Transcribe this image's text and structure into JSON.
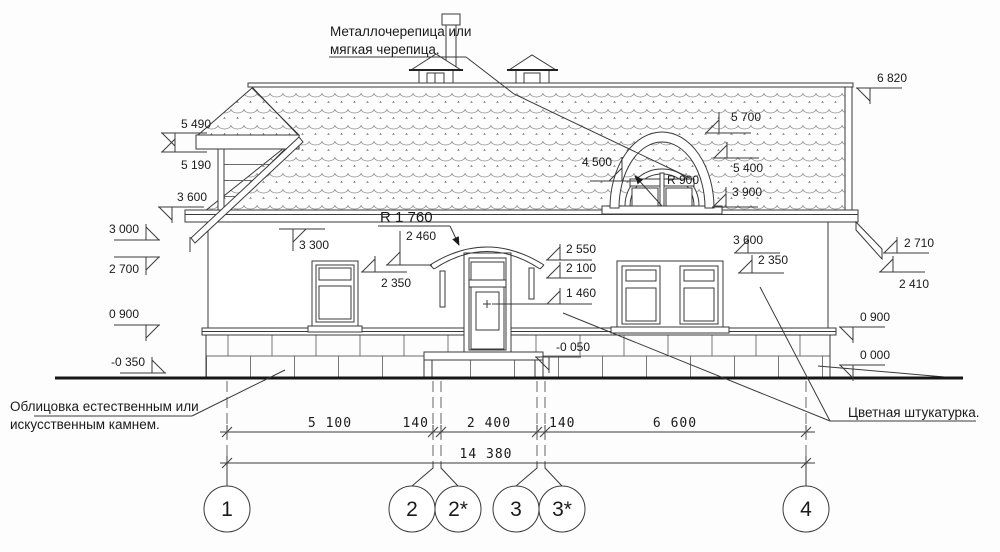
{
  "annotations": {
    "roof": {
      "line1": "Металлочерепица или",
      "line2": "мягкая черепица."
    },
    "stone": {
      "line1": "Облицовка естественным или",
      "line2": "искусственным камнем."
    },
    "plaster": {
      "line1": "Цветная штукатурка."
    }
  },
  "radius_marks": [
    {
      "label": "R 1 760",
      "x": 380,
      "y": 222,
      "big": true,
      "underline": [
        378,
        226,
        450,
        226
      ],
      "arrow": [
        450,
        226,
        459,
        245
      ]
    },
    {
      "label": "R 900",
      "x": 667,
      "y": 184,
      "big": false,
      "underline": null,
      "arrow": [
        662,
        206,
        635,
        176
      ]
    }
  ],
  "elevation_marks": [
    {
      "label": "5 490",
      "x": 175,
      "y": 133,
      "flag": "dl",
      "tx": 181,
      "ty": 128,
      "ta": "start"
    },
    {
      "label": "5 190",
      "x": 175,
      "y": 152,
      "flag": "ul",
      "tx": 181,
      "ty": 169,
      "ta": "start"
    },
    {
      "label": "3 600",
      "x": 172,
      "y": 207,
      "flag": "dl",
      "tx": 177,
      "ty": 201,
      "ta": "start"
    },
    {
      "label": "3 000",
      "x": 146,
      "y": 240,
      "flag": "ur",
      "tx": 139,
      "ty": 233,
      "ta": "end"
    },
    {
      "label": "2 700",
      "x": 146,
      "y": 257,
      "flag": "dr",
      "tx": 139,
      "ty": 273,
      "ta": "end"
    },
    {
      "label": "0 900",
      "x": 146,
      "y": 325,
      "flag": "dr",
      "tx": 139,
      "ty": 318,
      "ta": "end"
    },
    {
      "label": "-0 350",
      "x": 152,
      "y": 373,
      "flag": "ur",
      "tx": 145,
      "ty": 366,
      "ta": "end"
    },
    {
      "label": "6 820",
      "x": 870,
      "y": 88,
      "flag": "dl",
      "tx": 877,
      "ty": 82,
      "ta": "start"
    },
    {
      "label": "2 710",
      "x": 897,
      "y": 253,
      "flag": "ul",
      "tx": 904,
      "ty": 247,
      "ta": "start"
    },
    {
      "label": "2 410",
      "x": 893,
      "y": 272,
      "flag": "ul",
      "tx": 899,
      "ty": 288,
      "ta": "start"
    },
    {
      "label": "0 900",
      "x": 853,
      "y": 327,
      "flag": "dl",
      "tx": 860,
      "ty": 321,
      "ta": "start"
    },
    {
      "label": "0 000",
      "x": 853,
      "y": 365,
      "flag": "dl",
      "tx": 860,
      "ty": 359,
      "ta": "start"
    },
    {
      "label": "5 700",
      "x": 719,
      "y": 133,
      "flag": "ul",
      "tx": 731,
      "ty": 121,
      "ta": "start"
    },
    {
      "label": "5 400",
      "x": 727,
      "y": 158,
      "flag": "ul",
      "tx": 733,
      "ty": 172,
      "ta": "start"
    },
    {
      "label": "3 900",
      "x": 726,
      "y": 207,
      "flag": "ul",
      "tx": 732,
      "ty": 196,
      "ta": "start"
    },
    {
      "label": "3 600",
      "x": 748,
      "y": 253,
      "flag": "ul",
      "tx": 733,
      "ty": 244,
      "ta": "start"
    },
    {
      "label": "2 350",
      "x": 752,
      "y": 273,
      "flag": "ul",
      "tx": 758,
      "ty": 264,
      "ta": "start"
    },
    {
      "label": "3 300",
      "x": 293,
      "y": 229,
      "flag": "dr",
      "tx": 299,
      "ty": 249,
      "ta": "start"
    },
    {
      "label": "2 460",
      "x": 400,
      "y": 265,
      "flag": "ul",
      "tx": 406,
      "ty": 240,
      "ta": "start"
    },
    {
      "label": "2 350",
      "x": 375,
      "y": 272,
      "flag": "ul",
      "tx": 381,
      "ty": 287,
      "ta": "start"
    },
    {
      "label": "2 550",
      "x": 560,
      "y": 260,
      "flag": "ul",
      "tx": 566,
      "ty": 253,
      "ta": "start"
    },
    {
      "label": "2 100",
      "x": 560,
      "y": 278,
      "flag": "ul",
      "tx": 566,
      "ty": 272,
      "ta": "start"
    },
    {
      "label": "1 460",
      "x": 560,
      "y": 304,
      "flag": "ul",
      "tx": 566,
      "ty": 297,
      "ta": "start"
    },
    {
      "label": "4 500",
      "x": 622,
      "y": 181,
      "flag": "ul",
      "tx": 612,
      "ty": 166,
      "ta": "end"
    },
    {
      "label": "-0 050",
      "x": 549,
      "y": 357,
      "flag": "dl",
      "tx": 556,
      "ty": 351,
      "ta": "start"
    }
  ],
  "dimensions": {
    "y": 432,
    "x1": 220,
    "x2": 815,
    "ticks": [
      227,
      433,
      441,
      537,
      545,
      806
    ],
    "labels": [
      {
        "text": "5 100",
        "x": 330,
        "anchor": "middle"
      },
      {
        "text": "140",
        "x": 429,
        "anchor": "end"
      },
      {
        "text": "2 400",
        "x": 489,
        "anchor": "middle"
      },
      {
        "text": "140",
        "x": 549,
        "anchor": "start"
      },
      {
        "text": "6 600",
        "x": 675,
        "anchor": "middle"
      }
    ],
    "total": {
      "text": "14 380",
      "x": 486,
      "y": 463,
      "x1": 220,
      "x2": 815,
      "ticks": [
        227,
        806
      ]
    }
  },
  "axes": [
    {
      "label": "1",
      "x": 227,
      "bx": 227
    },
    {
      "label": "2",
      "x": 433,
      "bx": 412
    },
    {
      "label": "2*",
      "x": 441,
      "bx": 458
    },
    {
      "label": "3",
      "x": 537,
      "bx": 516
    },
    {
      "label": "3*",
      "x": 545,
      "bx": 562
    },
    {
      "label": "4",
      "x": 806,
      "bx": 806
    }
  ],
  "axis_bubble": {
    "cy": 509,
    "r": 23
  }
}
